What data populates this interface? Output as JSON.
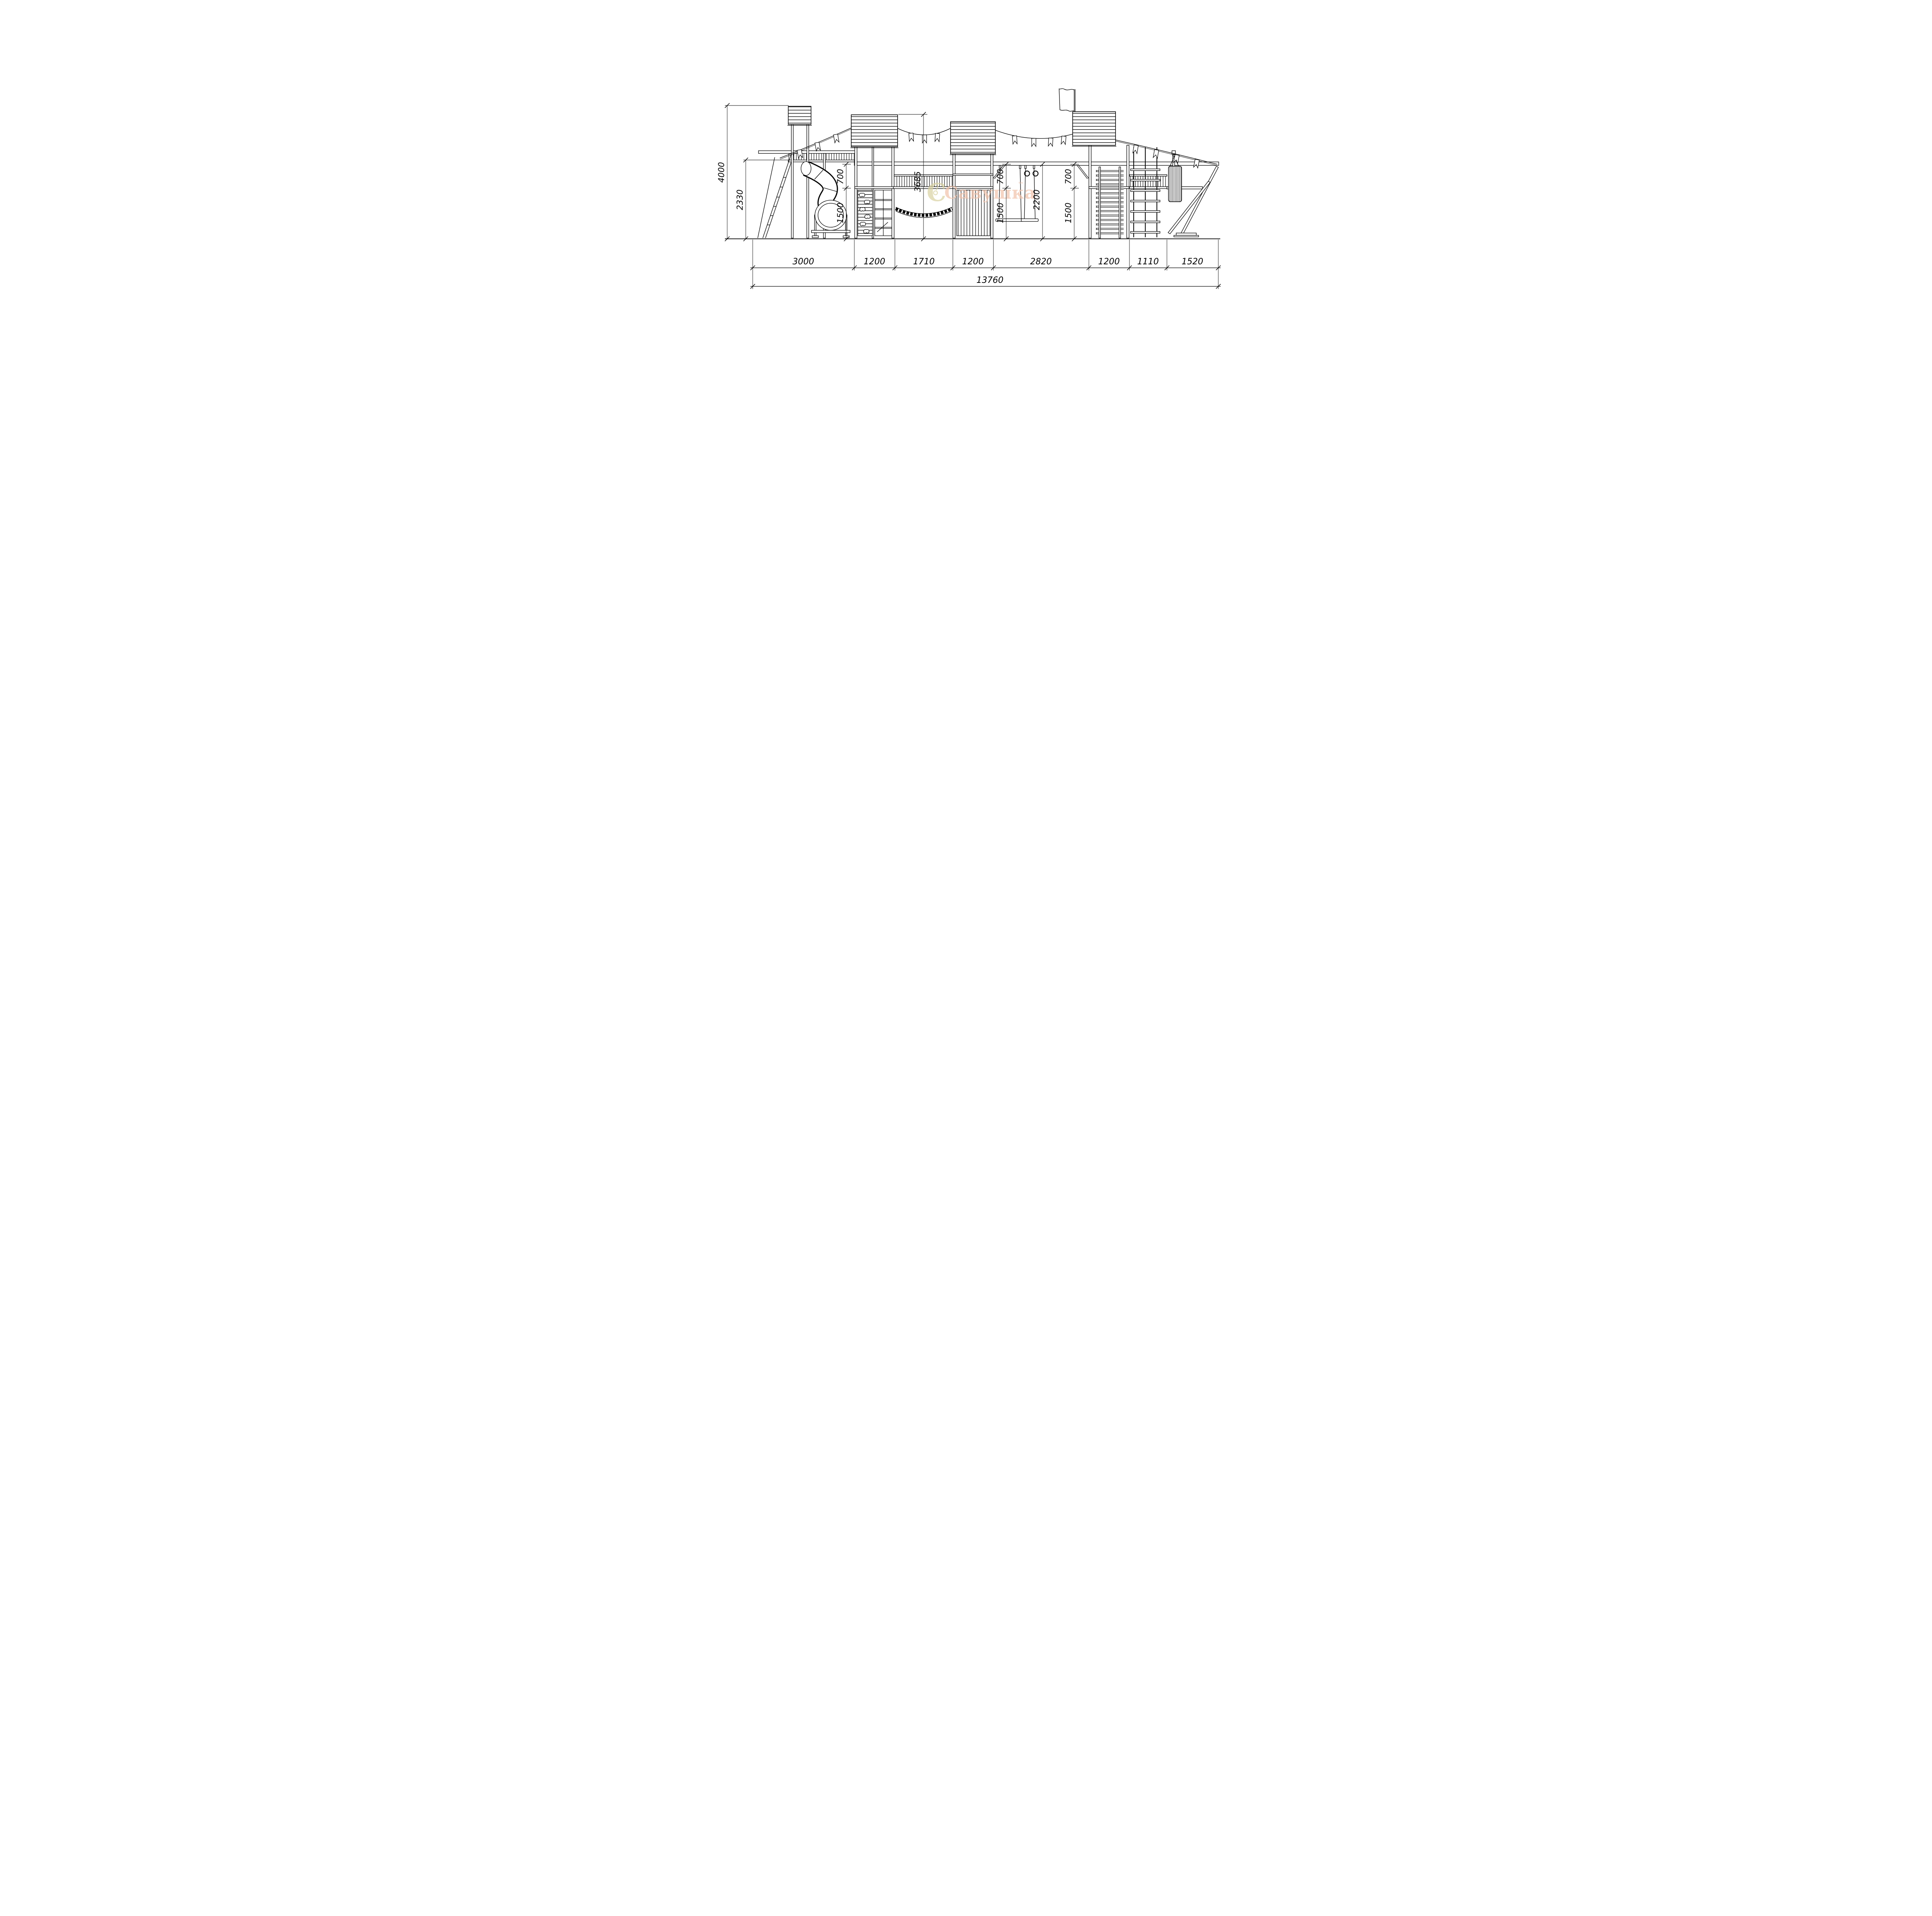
{
  "watermark": {
    "brand": "Савушка",
    "trademark": "™"
  },
  "dimensions": {
    "left": [
      {
        "id": "overall-height",
        "value": "4000"
      },
      {
        "id": "platform-height",
        "value": "2330"
      }
    ],
    "heights": [
      {
        "id": "h700-a",
        "value": "700"
      },
      {
        "id": "h1500-a",
        "value": "1500"
      },
      {
        "id": "h3685",
        "value": "3685"
      },
      {
        "id": "h700-b",
        "value": "700"
      },
      {
        "id": "h1500-b",
        "value": "1500"
      },
      {
        "id": "h2200",
        "value": "2200"
      },
      {
        "id": "h700-c",
        "value": "700"
      },
      {
        "id": "h1500-c",
        "value": "1500"
      }
    ],
    "widths": [
      {
        "id": "w-slide",
        "value": "3000"
      },
      {
        "id": "w-tower2",
        "value": "1200"
      },
      {
        "id": "w-bridge",
        "value": "1710"
      },
      {
        "id": "w-tower3",
        "value": "1200"
      },
      {
        "id": "w-swings",
        "value": "2820"
      },
      {
        "id": "w-tower4",
        "value": "1200"
      },
      {
        "id": "w-net",
        "value": "1110"
      },
      {
        "id": "w-end",
        "value": "1520"
      }
    ],
    "total_width": "13760"
  },
  "colors": {
    "line": "#000000",
    "background": "#ffffff",
    "watermark_c": "#d9d2a2",
    "watermark_text": "#f2c3ab"
  }
}
